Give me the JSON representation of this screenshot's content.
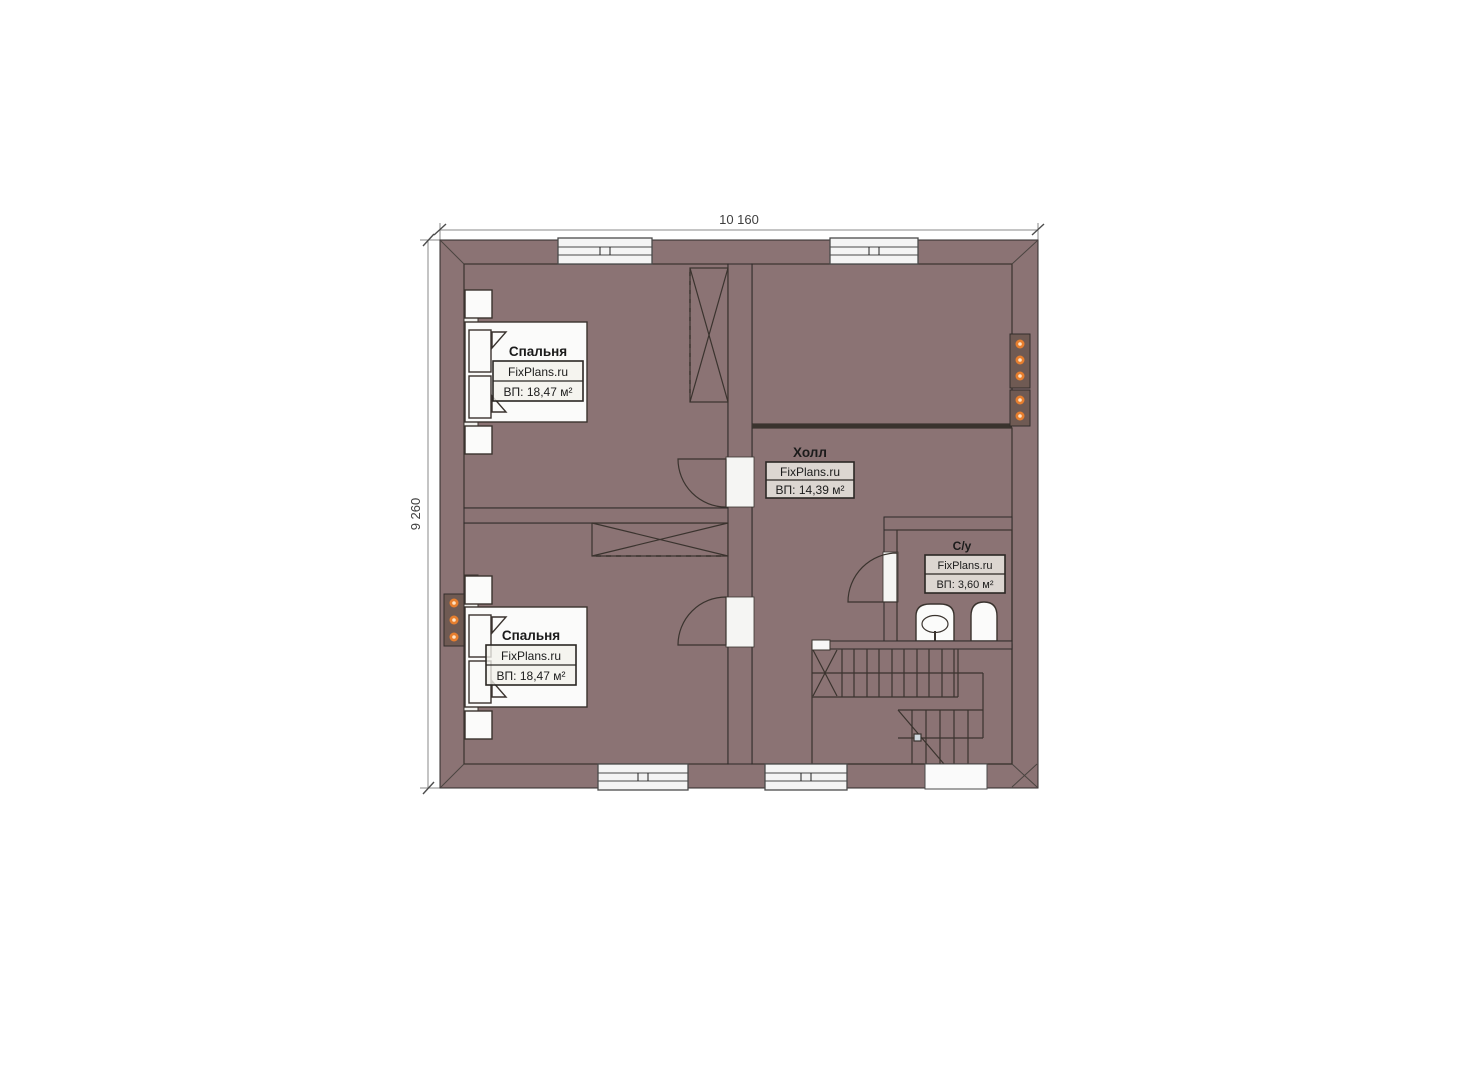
{
  "dimensions": {
    "width_label": "10 160",
    "height_label": "9 260"
  },
  "rooms": {
    "bedroom_top": {
      "title": "Спальня",
      "brand": "FixPlans.ru",
      "area": "ВП: 18,47 м²"
    },
    "bedroom_bottom": {
      "title": "Спальня",
      "brand": "FixPlans.ru",
      "area": "ВП: 18,47 м²"
    },
    "hall": {
      "title": "Холл",
      "brand": "FixPlans.ru",
      "area": "ВП: 14,39 м²"
    },
    "bathroom": {
      "title": "С/у",
      "brand": "FixPlans.ru",
      "area": "ВП: 3,60 м²"
    }
  },
  "colors": {
    "wall": "#8b7374",
    "bedroom_floor": "#8b754e",
    "hall_tile": "#d7bd90",
    "bathroom_tile": "#b3d8f2",
    "stairs_floor": "#ececec",
    "accent_dot": "#e67e2e"
  }
}
